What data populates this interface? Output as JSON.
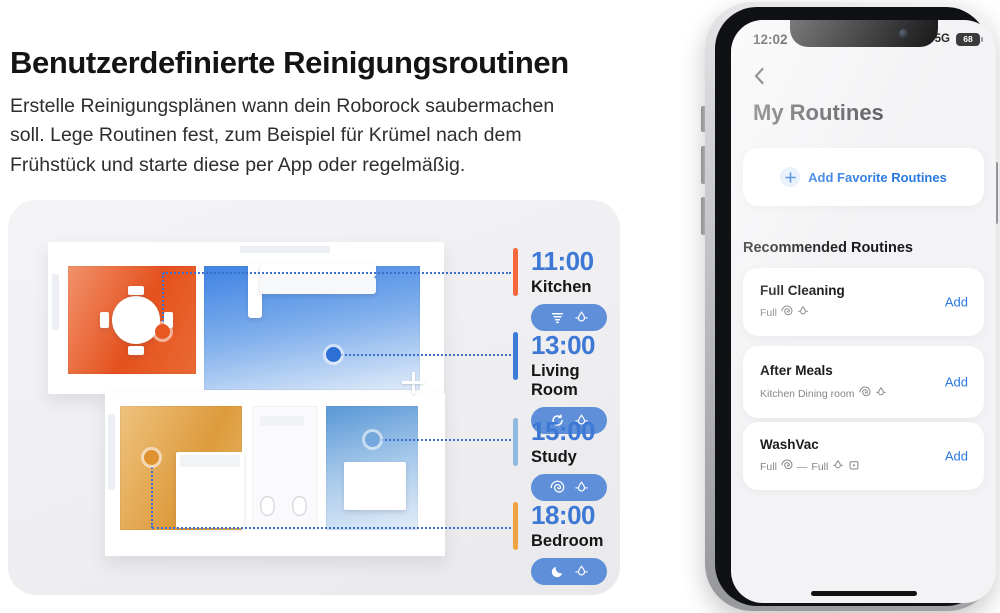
{
  "hero": {
    "title": "Benutzerdefinierte Reinigungsroutinen",
    "desc_lines": [
      "Erstelle Reinigungsplänen wann dein Roborock saubermachen",
      "soll. Lege Routinen fest, zum Beispiel für Krümel nach dem",
      "Frühstück und starte diese per App oder regelmäßig."
    ]
  },
  "schedule": {
    "time_color": "#3c78d4",
    "pill_color": "#5e8fd8",
    "leader_line_color": "#3a6fce",
    "items": [
      {
        "time": "11:00",
        "room": "Kitchen",
        "bar_color": "#f4683c",
        "dot_color": "#e8571f",
        "icons": [
          "vacuum-icon",
          "mop-icon"
        ]
      },
      {
        "time": "13:00",
        "room": "Living Room",
        "bar_color": "#3d7bd8",
        "dot_color": "#2e6fd4",
        "icons": [
          "cyclone-icon",
          "mop-icon"
        ]
      },
      {
        "time": "15:00",
        "room": "Study",
        "bar_color": "#8fb9de",
        "dot_color": "#74a7dc",
        "icons": [
          "spiral-icon",
          "mop-icon"
        ]
      },
      {
        "time": "18:00",
        "room": "Bedroom",
        "bar_color": "#eda440",
        "dot_color": "#de9330",
        "icons": [
          "moon-icon",
          "mop-icon"
        ]
      }
    ]
  },
  "floorplan": {
    "room_floor_colors": {
      "kitchen": "#e4511e",
      "living_room": "#4486e4",
      "bedroom": "#dd9b3c",
      "bathroom": "#fafafc",
      "study": "#5f9bd8"
    }
  },
  "phone": {
    "accent_color": "#2979e0",
    "status": {
      "time": "12:02",
      "network": "5G",
      "battery": "68"
    },
    "title": "My Routines",
    "add_favorite_label": "Add Favorite Routines",
    "section_title": "Recommended Routines",
    "routines": [
      {
        "title": "Full Cleaning",
        "subtitle": "Full",
        "action_label": "Add"
      },
      {
        "title": "After Meals",
        "subtitle": "Kitchen Dining room",
        "action_label": "Add"
      },
      {
        "title": "WashVac",
        "subtitle_first": "Full",
        "subtitle_dash": "—",
        "subtitle_second": "Full",
        "action_label": "Add"
      }
    ]
  }
}
